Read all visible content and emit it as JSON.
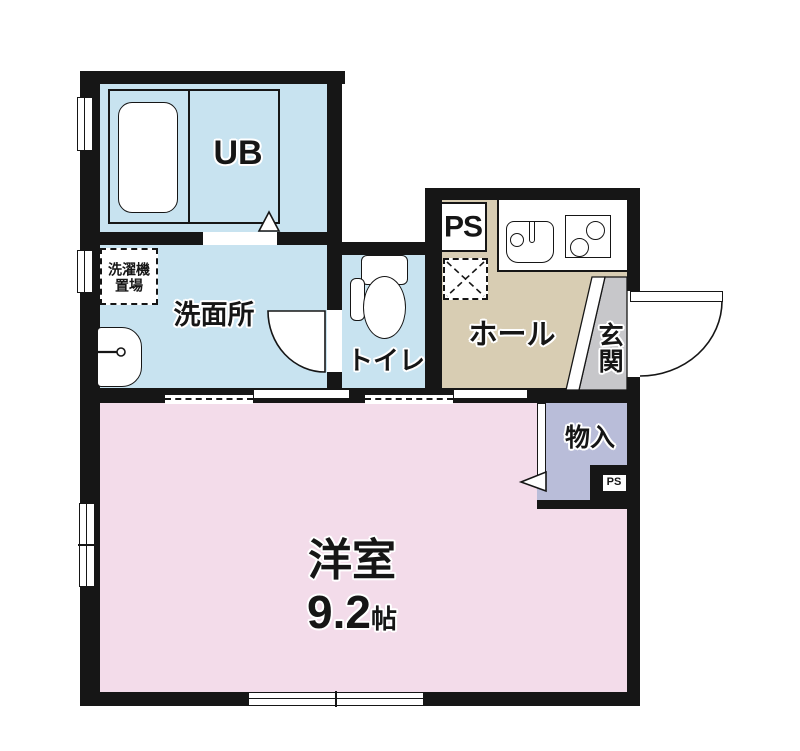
{
  "plan": {
    "rooms": {
      "unit_bath": {
        "label": "UB"
      },
      "laundry_space": {
        "line1": "洗濯機",
        "line2": "置場"
      },
      "washroom": {
        "label": "洗面所"
      },
      "toilet": {
        "label": "トイレ"
      },
      "pipe_space_top": {
        "label": "PS"
      },
      "hall": {
        "label": "ホール"
      },
      "entrance": {
        "label": "玄関"
      },
      "storage": {
        "label": "物入"
      },
      "pipe_space_bottom": {
        "label": "PS"
      },
      "western_room": {
        "label": "洋室",
        "area_value": "9.2",
        "area_unit": "帖"
      }
    },
    "colors": {
      "wall": "#161616",
      "wet_area": "#c8e3f0",
      "hall_floor": "#d8cdb3",
      "room_floor": "#f3dcea",
      "storage_floor": "#b9bdd9",
      "entrance_floor": "#c7c7ca",
      "fixture": "#ffffff"
    }
  }
}
